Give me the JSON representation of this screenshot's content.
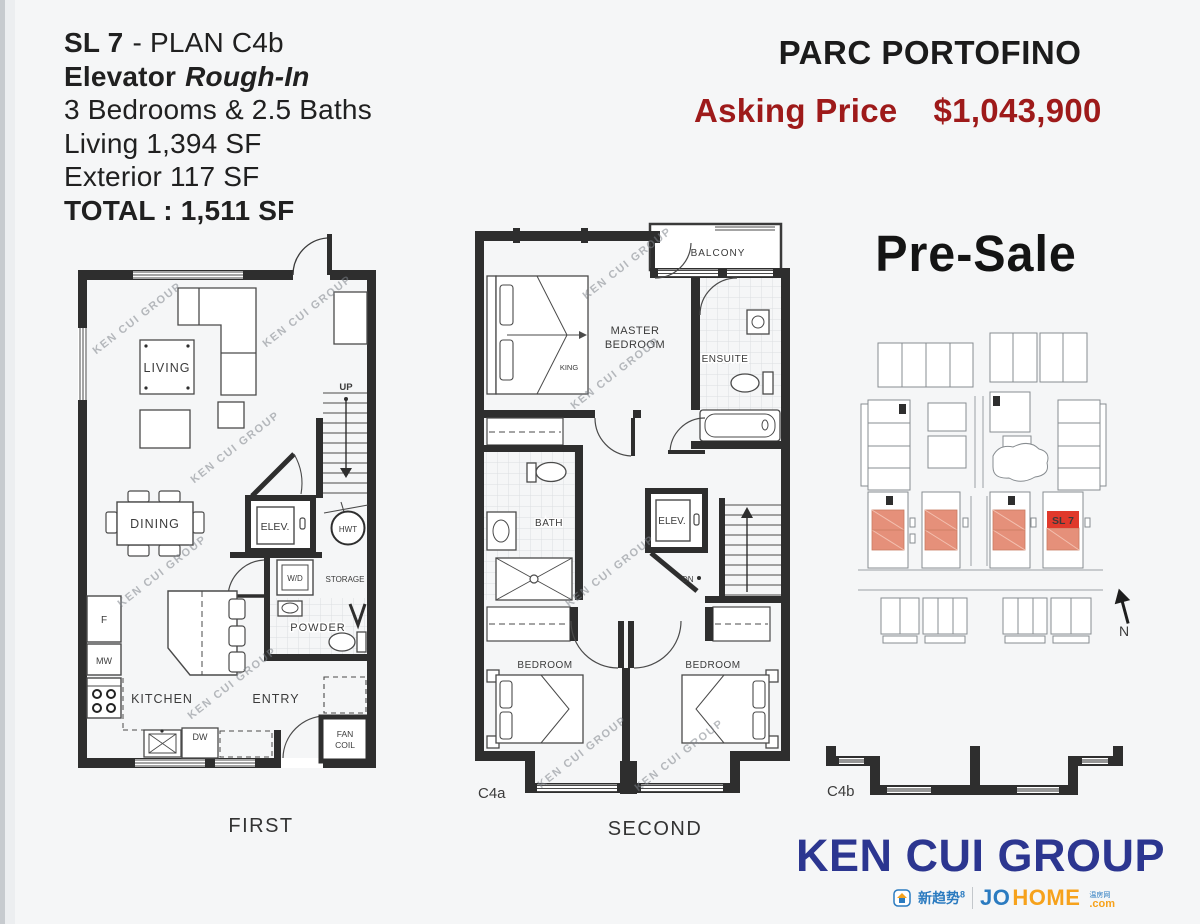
{
  "unit_info": {
    "unit_bold": "SL 7",
    "unit_rest": "- PLAN C4b",
    "feature_bold": "Elevator",
    "feature_italic": "Rough-In",
    "beds": "3 Bedrooms & 2.5 Baths",
    "living": "Living 1,394 SF",
    "exterior": "Exterior 117 SF",
    "total": "TOTAL : 1,511 SF"
  },
  "header": {
    "project": "PARC PORTOFINO",
    "asking_label": "Asking Price",
    "asking_value": "$1,043,900",
    "presale": "Pre-Sale"
  },
  "first_floor": {
    "caption": "FIRST",
    "labels": {
      "living": "LIVING",
      "dining": "DINING",
      "elevator": "ELEV.",
      "hwt": "HWT",
      "washer_dryer": "W/D",
      "storage": "STORAGE",
      "powder": "POWDER",
      "fridge": "F",
      "microwave": "MW",
      "kitchen": "KITCHEN",
      "entry": "ENTRY",
      "dishwasher": "DW",
      "fan": "FAN",
      "coil": "COIL",
      "up": "UP"
    }
  },
  "second_floor": {
    "caption": "SECOND",
    "plan_code": "C4a",
    "labels": {
      "master1": "MASTER",
      "master2": "BEDROOM",
      "king": "KING",
      "balcony": "BALCONY",
      "ensuite": "ENSUITE",
      "bath": "BATH",
      "elevator": "ELEV.",
      "down": "DN",
      "bedroom": "BEDROOM"
    }
  },
  "site_plan": {
    "unit": "SL 7",
    "north": "N"
  },
  "section": {
    "code": "C4b"
  },
  "brand": {
    "name": "KEN CUI GROUP",
    "cn_logo": "新趋势",
    "cn_logo_sup": "8",
    "jo": "JO",
    "home": "HOME",
    "cn_small": "温房网",
    "com": ".com"
  },
  "watermark": {
    "text": "KEN CUI GROUP"
  },
  "colors": {
    "price_red": "#9e1a1a",
    "highlight_red": "#e0392b",
    "highlight_salmon": "#e5907a",
    "brand_blue": "#2c3690",
    "johome_blue": "#2b7bc0",
    "johome_orange": "#f6a21c"
  }
}
